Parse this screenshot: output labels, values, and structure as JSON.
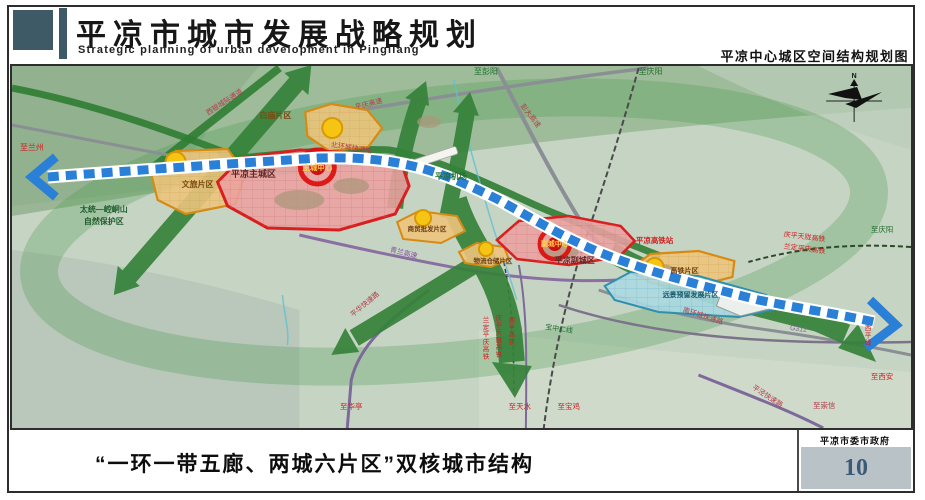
{
  "header": {
    "title": "平凉市城市发展战略规划",
    "subtitle_en": "Strategic planning of urban development in Pingliang",
    "right_caption": "平凉中心城区空间结构规划图"
  },
  "footer": {
    "caption": "“一环一带五廊、两城六片区”双核城市结构",
    "agency": "平凉市委市政府",
    "page_number": "10"
  },
  "colors": {
    "header_block": "#3d5a66",
    "corridor_green": "#35823a",
    "belt_blue": "#2a7fd6",
    "zone_pink": "#eba0a0",
    "zone_orange": "#ecc47c",
    "zone_blue": "#abd9e2",
    "core_red": "#cc1111",
    "badge_bg": "#b8c2c7"
  },
  "map": {
    "labels": [
      {
        "id": "label-to-lanzhou",
        "text": "至兰州",
        "x": 32,
        "y": 150,
        "c": "#cc2222",
        "s": 8
      },
      {
        "id": "label-nature-reserve-line1",
        "text": "太统—崆峒山",
        "x": 104,
        "y": 212,
        "c": "#1f5e2d",
        "s": 8,
        "b": true
      },
      {
        "id": "label-nature-reserve-line2",
        "text": "自然保护区",
        "x": 104,
        "y": 224,
        "c": "#1f5e2d",
        "s": 8,
        "b": true
      },
      {
        "id": "label-wenlv-district",
        "text": "文旅片区",
        "x": 198,
        "y": 187,
        "c": "#7a4a10",
        "s": 8,
        "b": true
      },
      {
        "id": "label-baimiao-district",
        "text": "白庙片区",
        "x": 276,
        "y": 118,
        "c": "#7a4a10",
        "s": 8,
        "b": true
      },
      {
        "id": "label-main-city",
        "text": "平凉主城区",
        "x": 254,
        "y": 177,
        "c": "#5e2727",
        "s": 9,
        "b": true
      },
      {
        "id": "label-main-core",
        "text": "主城中心",
        "x": 318,
        "y": 170,
        "c": "#ffd24a",
        "s": 7.5,
        "b": true
      },
      {
        "id": "label-xiyin-corridor",
        "text": "西银城际通道",
        "x": 226,
        "y": 104,
        "c": "#b23a48",
        "s": 7,
        "r": -33
      },
      {
        "id": "label-beihuan-road",
        "text": "北环城快速路",
        "x": 352,
        "y": 150,
        "c": "#b23a48",
        "s": 7,
        "r": 9
      },
      {
        "id": "label-pingqing-expwy",
        "text": "平庆高速",
        "x": 370,
        "y": 106,
        "c": "#b23a48",
        "s": 7,
        "r": -14
      },
      {
        "id": "label-to-pengyang",
        "text": "至彭阳",
        "x": 487,
        "y": 74,
        "c": "#1f6e2e",
        "s": 8
      },
      {
        "id": "label-pengda-expwy",
        "text": "彭大高速",
        "x": 530,
        "y": 117,
        "c": "#b23a48",
        "s": 7,
        "r": 52
      },
      {
        "id": "label-to-qingyang-top",
        "text": "至庆阳",
        "x": 652,
        "y": 74,
        "c": "#1f6e2e",
        "s": 8
      },
      {
        "id": "label-airport",
        "text": "平凉机场",
        "x": 452,
        "y": 179,
        "c": "#1f6e2e",
        "s": 8,
        "b": true
      },
      {
        "id": "label-qinglan-expwy",
        "text": "青兰高速",
        "x": 404,
        "y": 255,
        "c": "#8050a0",
        "s": 7,
        "r": 14
      },
      {
        "id": "label-shangmao-district",
        "text": "商贸批发片区",
        "x": 428,
        "y": 231,
        "c": "#6b3a10",
        "s": 6.5,
        "b": true
      },
      {
        "id": "label-wuliu-district",
        "text": "物流仓储片区",
        "x": 494,
        "y": 263,
        "c": "#6b3a10",
        "s": 6.5,
        "b": true
      },
      {
        "id": "label-sub-core",
        "text": "副城中心",
        "x": 556,
        "y": 246,
        "c": "#ffd24a",
        "s": 7,
        "b": true
      },
      {
        "id": "label-sub-city",
        "text": "平凉副城区",
        "x": 576,
        "y": 263,
        "c": "#5e2727",
        "s": 8,
        "b": true
      },
      {
        "id": "label-hsr-station",
        "text": "平凉高铁站",
        "x": 656,
        "y": 243,
        "c": "#cc2222",
        "s": 7.5,
        "b": true
      },
      {
        "id": "label-gaotie-district",
        "text": "高铁片区",
        "x": 686,
        "y": 273,
        "c": "#6b3a10",
        "s": 7,
        "b": true
      },
      {
        "id": "label-yuanjing-district",
        "text": "远景预留发展片区",
        "x": 692,
        "y": 297,
        "c": "#1a5a6e",
        "s": 7,
        "b": true
      },
      {
        "id": "label-qingping-hsr",
        "text": "庆平天陇高铁",
        "x": 806,
        "y": 239,
        "c": "#cc2222",
        "s": 7,
        "r": 7
      },
      {
        "id": "label-landing-hsr",
        "text": "兰定平庆高铁",
        "x": 806,
        "y": 251,
        "c": "#cc2222",
        "s": 7,
        "r": 7
      },
      {
        "id": "label-to-qingyang-right",
        "text": "至庆阳",
        "x": 884,
        "y": 232,
        "c": "#1f6e2e",
        "s": 7.5
      },
      {
        "id": "label-nanhuan-road",
        "text": "南环城快速路",
        "x": 704,
        "y": 318,
        "c": "#b23a48",
        "s": 7,
        "r": 17
      },
      {
        "id": "label-g312",
        "text": "G312",
        "x": 800,
        "y": 331,
        "c": "#7a6a8a",
        "s": 7,
        "r": 8
      },
      {
        "id": "label-xiping-line",
        "text": "西平线",
        "x": 870,
        "y": 330,
        "c": "#cc2222",
        "s": 6.5,
        "v": true
      },
      {
        "id": "label-to-xian",
        "text": "至西安",
        "x": 884,
        "y": 379,
        "c": "#cc2222",
        "s": 7.5
      },
      {
        "id": "label-pingjing-road",
        "text": "平泾快速路",
        "x": 768,
        "y": 398,
        "c": "#b23a48",
        "s": 7,
        "r": 33
      },
      {
        "id": "label-to-chongxin",
        "text": "至崇信",
        "x": 826,
        "y": 408,
        "c": "#b23a48",
        "s": 7.5
      },
      {
        "id": "label-pinghua-road",
        "text": "平华快速路",
        "x": 367,
        "y": 306,
        "c": "#b23a48",
        "s": 7,
        "r": -40
      },
      {
        "id": "label-to-huating",
        "text": "至华亭",
        "x": 352,
        "y": 409,
        "c": "#cc2222",
        "s": 7.5
      },
      {
        "id": "label-landing-hsr-v",
        "text": "兰定平庆高铁",
        "x": 487,
        "y": 322,
        "c": "#cc2222",
        "s": 6.5,
        "v": true
      },
      {
        "id": "label-qingping-hsr-v",
        "text": "庆平天陇高铁",
        "x": 500,
        "y": 320,
        "c": "#cc2222",
        "s": 6.5,
        "v": true
      },
      {
        "id": "label-xiping-hsr-v",
        "text": "西平高铁",
        "x": 513,
        "y": 322,
        "c": "#cc2222",
        "s": 6.5,
        "v": true
      },
      {
        "id": "label-baozhong-line2",
        "text": "宝中二线",
        "x": 560,
        "y": 331,
        "c": "#1f6e2e",
        "s": 7,
        "r": 8
      },
      {
        "id": "label-to-tianshui",
        "text": "至天水",
        "x": 521,
        "y": 409,
        "c": "#cc2222",
        "s": 7.5
      },
      {
        "id": "label-to-baoji",
        "text": "至宝鸡",
        "x": 570,
        "y": 409,
        "c": "#cc2222",
        "s": 7.5
      },
      {
        "id": "label-compass-n",
        "text": "N",
        "x": 856,
        "y": 78,
        "c": "#111111",
        "s": 7,
        "b": true
      }
    ]
  }
}
